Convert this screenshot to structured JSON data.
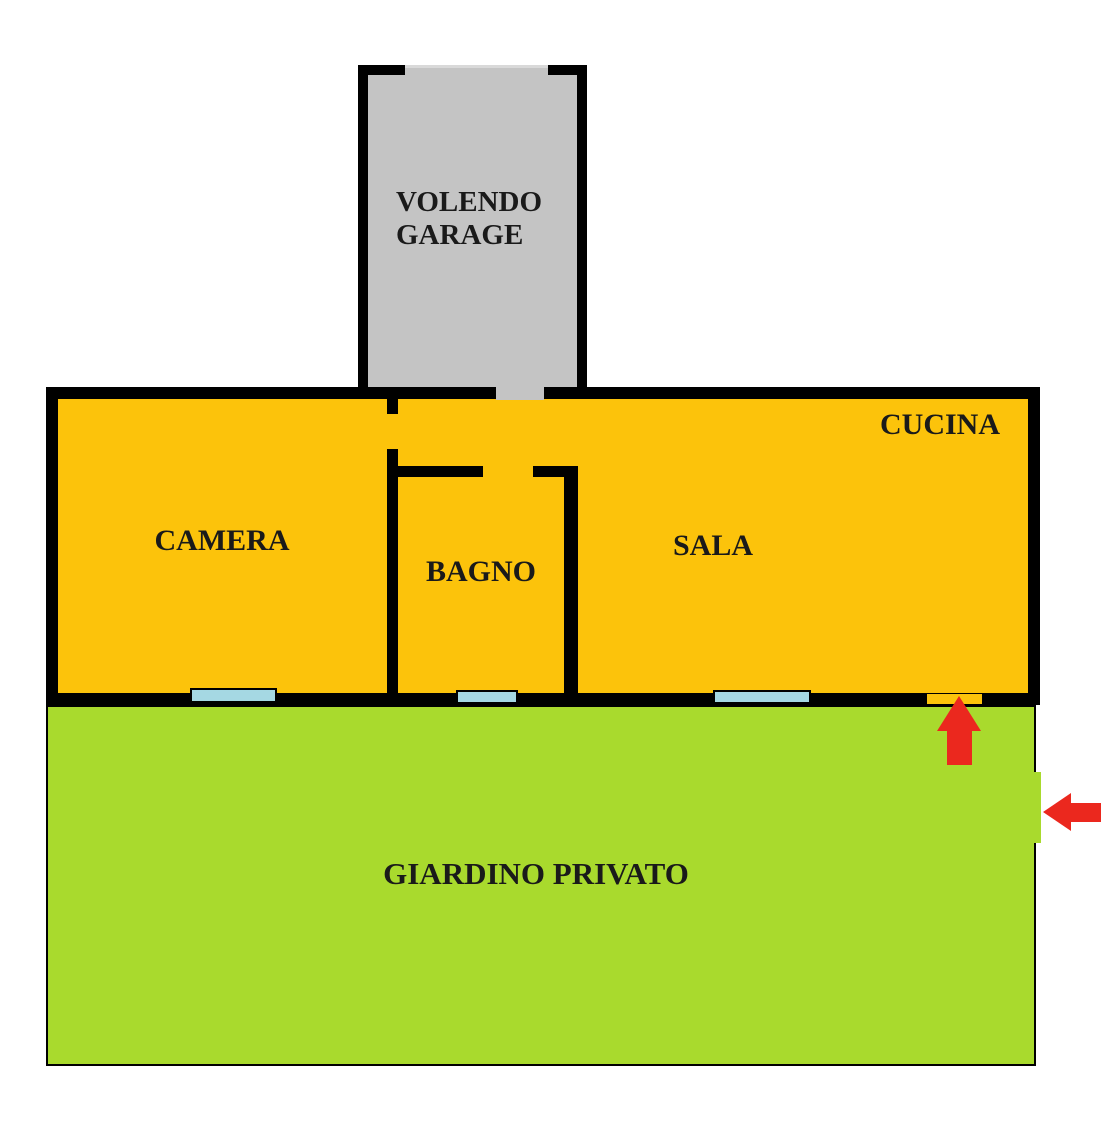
{
  "floorplan": {
    "garage": {
      "label": "VOLENDO GARAGE"
    },
    "rooms": {
      "camera": {
        "label": "CAMERA"
      },
      "bagno": {
        "label": "BAGNO"
      },
      "sala": {
        "label": "SALA"
      },
      "cucina": {
        "label": "CUCINA"
      }
    },
    "garden": {
      "label": "GIARDINO PRIVATO"
    },
    "icons": {
      "garden_entrance_arrow": "up-arrow-icon",
      "gate_entrance_arrow": "left-arrow-icon"
    },
    "colors": {
      "wall": "#000000",
      "room_fill": "#FCC30B",
      "garage_fill": "#C4C4C4",
      "garden_fill": "#A9DA2D",
      "window_fill": "#A5D8E3",
      "arrow_red": "#EB281E",
      "label_text": "#1A1A1A"
    }
  }
}
